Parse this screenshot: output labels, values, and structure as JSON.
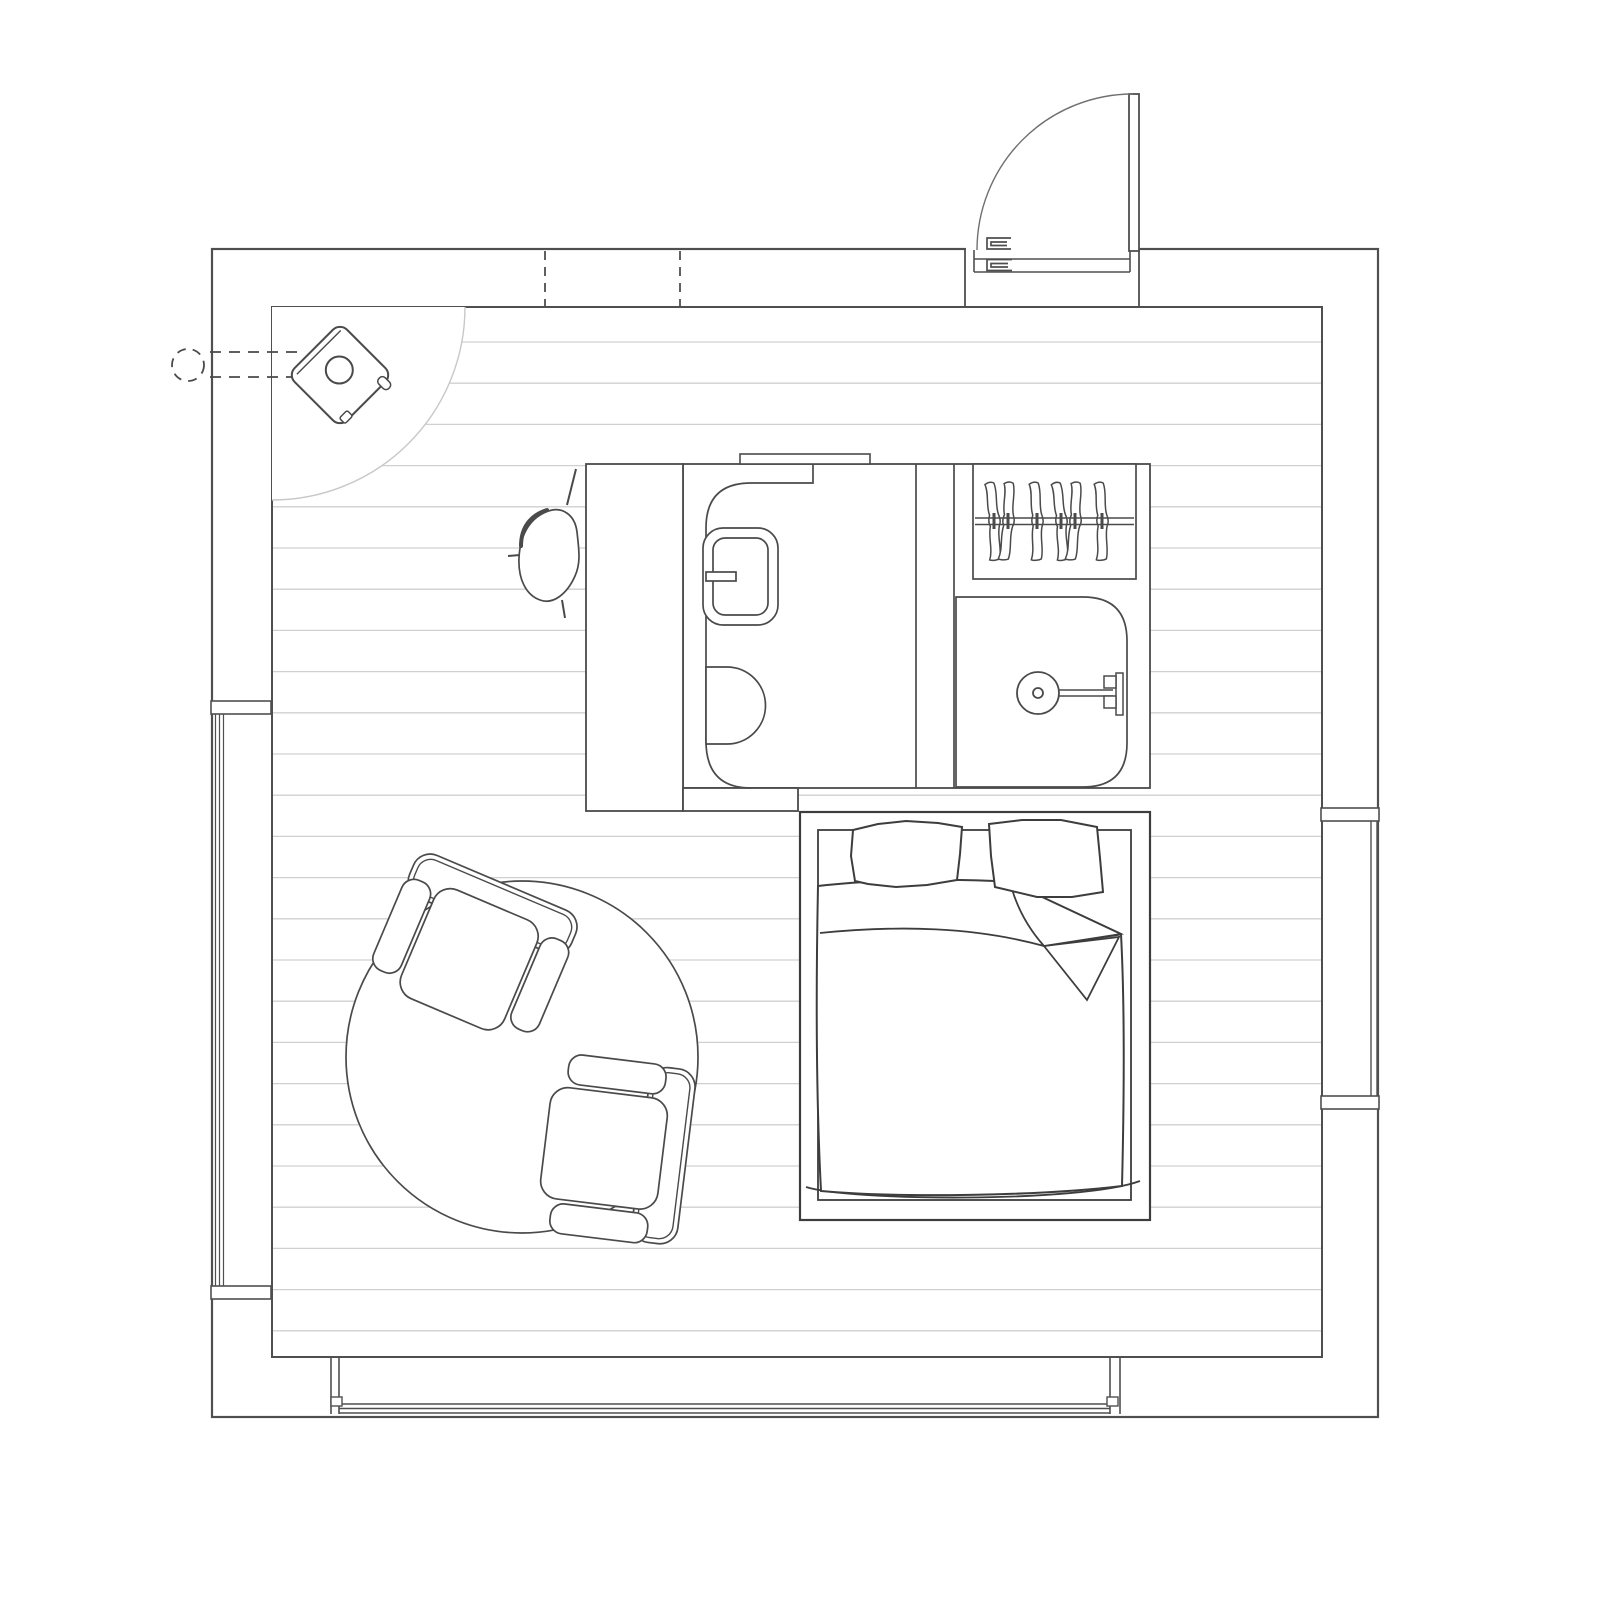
{
  "drawing": {
    "type": "floor-plan"
  },
  "palette": {
    "background": "#ffffff",
    "wall_line": "#4f4f4f",
    "furniture_line": "#4a4a4a",
    "bed_line": "#3d3d3d",
    "floorboard_line": "#d0d0d0",
    "clearance_arc_line": "#c8c8c8",
    "door_arc_line": "#6f6f6f",
    "white": "#ffffff"
  },
  "floor": {
    "board_count": 25,
    "first_y": 342,
    "spacing": 41.2,
    "x_start": 273,
    "x_end": 1321
  },
  "wardrobe": {
    "rail_y": 521,
    "hanger_x": [
      995,
      1009,
      1038,
      1062,
      1076,
      1103
    ],
    "hanger_tilt": [
      -4,
      4,
      -2,
      -5,
      4,
      -2
    ]
  },
  "items": [
    {
      "name": "outer-wall"
    },
    {
      "name": "inner-room"
    },
    {
      "name": "wood-floorboards"
    },
    {
      "name": "entry-door"
    },
    {
      "name": "door-swing-arc"
    },
    {
      "name": "wood-stove"
    },
    {
      "name": "stove-flue-dashed"
    },
    {
      "name": "hearth-clearance-arc"
    },
    {
      "name": "desk"
    },
    {
      "name": "desk-chair"
    },
    {
      "name": "bathroom-pod"
    },
    {
      "name": "washbasin"
    },
    {
      "name": "toilet"
    },
    {
      "name": "wardrobe-rail"
    },
    {
      "name": "clothes-hanger"
    },
    {
      "name": "shower"
    },
    {
      "name": "shower-head"
    },
    {
      "name": "bed"
    },
    {
      "name": "pillow"
    },
    {
      "name": "duvet"
    },
    {
      "name": "rug"
    },
    {
      "name": "armchair"
    },
    {
      "name": "window-left"
    },
    {
      "name": "window-right"
    },
    {
      "name": "window-bottom"
    },
    {
      "name": "wall-break-lines"
    }
  ]
}
